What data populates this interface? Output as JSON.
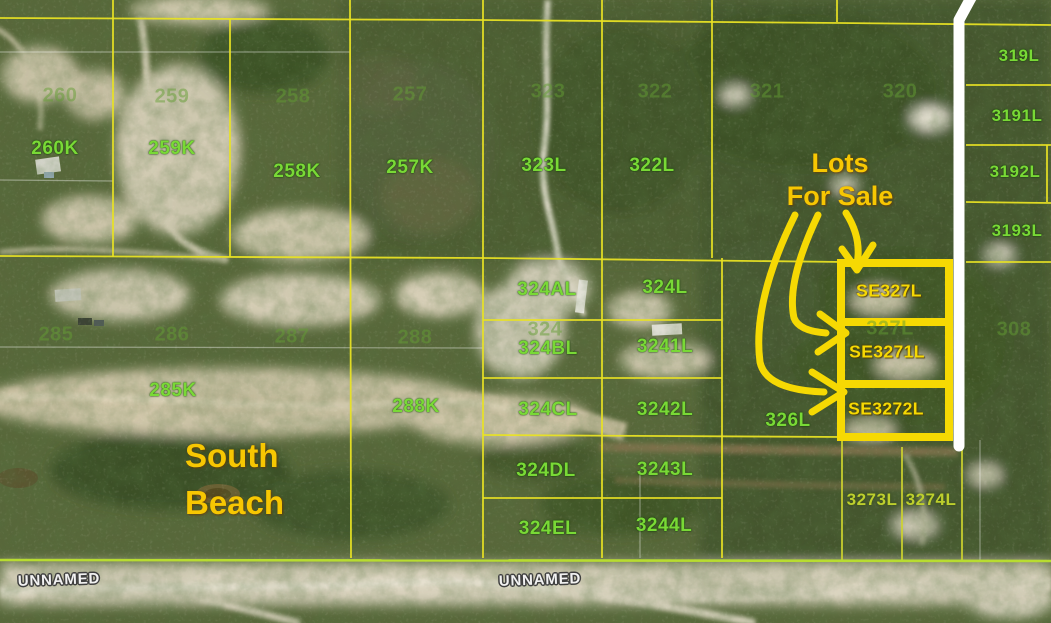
{
  "title": "Aerial parcel map with lots for sale",
  "colors": {
    "parcel_line": "#e8e224",
    "boundary_green": "#b8dc30",
    "strip_line": "#cdd42e",
    "highlight": "#f6d903",
    "annotation": "#f7c702",
    "bright_label": "#79d936",
    "yg_label": "#bdcf2d",
    "faint_label": "rgba(100,158,52,0.50)",
    "road_text": "#f2f2f2",
    "road_outline": "#3f3f3f",
    "band_white": "#ffffff"
  },
  "annotations": {
    "lots_line1": "Lots",
    "lots_line2": "For Sale",
    "beach_line1": "South",
    "beach_line2": "Beach"
  },
  "labels": {
    "bright": [
      {
        "t": "260K",
        "x": 55,
        "y": 149
      },
      {
        "t": "259K",
        "x": 172,
        "y": 149
      },
      {
        "t": "258K",
        "x": 297,
        "y": 172
      },
      {
        "t": "257K",
        "x": 410,
        "y": 168
      },
      {
        "t": "323L",
        "x": 544,
        "y": 166
      },
      {
        "t": "322L",
        "x": 652,
        "y": 166
      },
      {
        "t": "319L",
        "x": 1019,
        "y": 56,
        "s": 17
      },
      {
        "t": "3191L",
        "x": 1017,
        "y": 116,
        "s": 17
      },
      {
        "t": "3192L",
        "x": 1015,
        "y": 172,
        "s": 17
      },
      {
        "t": "3193L",
        "x": 1017,
        "y": 231,
        "s": 17
      },
      {
        "t": "324AL",
        "x": 547,
        "y": 290
      },
      {
        "t": "324L",
        "x": 665,
        "y": 288
      },
      {
        "t": "324BL",
        "x": 548,
        "y": 349
      },
      {
        "t": "3241L",
        "x": 665,
        "y": 347
      },
      {
        "t": "324CL",
        "x": 548,
        "y": 410
      },
      {
        "t": "3242L",
        "x": 665,
        "y": 410
      },
      {
        "t": "326L",
        "x": 788,
        "y": 421
      },
      {
        "t": "324DL",
        "x": 546,
        "y": 471
      },
      {
        "t": "3243L",
        "x": 665,
        "y": 470
      },
      {
        "t": "324EL",
        "x": 548,
        "y": 529
      },
      {
        "t": "3244L",
        "x": 664,
        "y": 526
      },
      {
        "t": "285K",
        "x": 173,
        "y": 391
      },
      {
        "t": "288K",
        "x": 416,
        "y": 407
      }
    ],
    "yellow_green": [
      {
        "t": "3273L",
        "x": 872,
        "y": 500
      },
      {
        "t": "3274L",
        "x": 931,
        "y": 500
      }
    ],
    "faint": [
      {
        "t": "260",
        "x": 60,
        "y": 96
      },
      {
        "t": "259",
        "x": 172,
        "y": 97
      },
      {
        "t": "258",
        "x": 293,
        "y": 97
      },
      {
        "t": "257",
        "x": 410,
        "y": 95
      },
      {
        "t": "323",
        "x": 548,
        "y": 92
      },
      {
        "t": "322",
        "x": 655,
        "y": 92
      },
      {
        "t": "321",
        "x": 767,
        "y": 92
      },
      {
        "t": "320",
        "x": 900,
        "y": 92
      },
      {
        "t": "285",
        "x": 56,
        "y": 335
      },
      {
        "t": "286",
        "x": 172,
        "y": 335
      },
      {
        "t": "287",
        "x": 292,
        "y": 337
      },
      {
        "t": "288",
        "x": 415,
        "y": 338
      },
      {
        "t": "324",
        "x": 545,
        "y": 330
      },
      {
        "t": "327L",
        "x": 890,
        "y": 329
      },
      {
        "t": "308",
        "x": 1014,
        "y": 330
      }
    ],
    "sale": [
      {
        "t": "SE327L",
        "x": 889,
        "y": 291
      },
      {
        "t": "SE3271L",
        "x": 887,
        "y": 352
      },
      {
        "t": "SE3272L",
        "x": 886,
        "y": 409
      }
    ],
    "roads": [
      {
        "t": "UNNAMED",
        "x": 59,
        "y": 580
      },
      {
        "t": "UNNAMED",
        "x": 540,
        "y": 580
      }
    ]
  }
}
